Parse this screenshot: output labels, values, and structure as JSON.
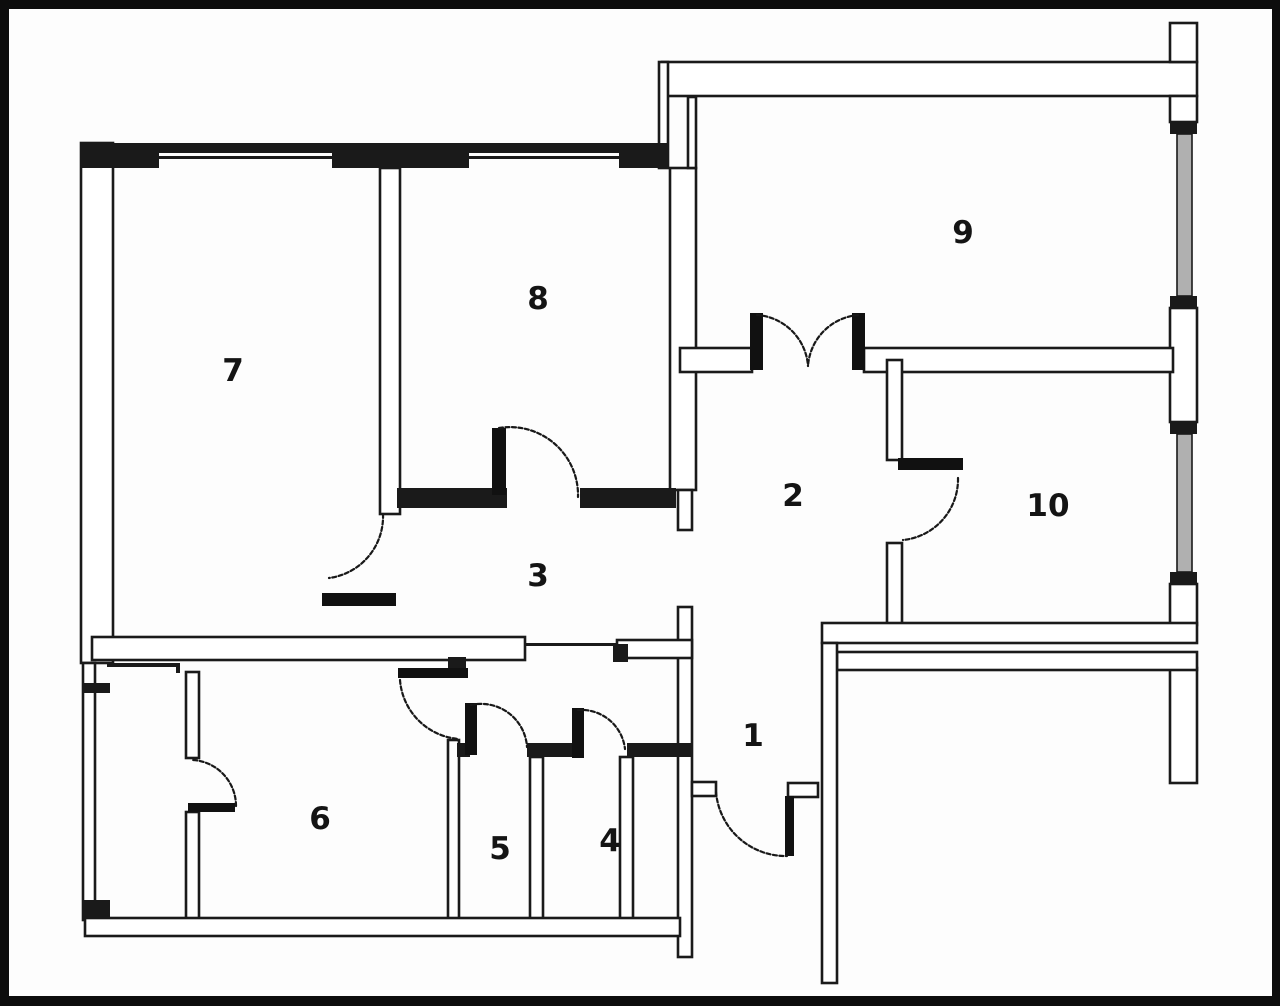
{
  "diagram": {
    "type": "floor-plan",
    "background_color": "#fdfdfd",
    "wall_color": "#1a1a1a",
    "glazing_color": "#b0b0b0",
    "rooms": [
      {
        "label": "1"
      },
      {
        "label": "2"
      },
      {
        "label": "3"
      },
      {
        "label": "4"
      },
      {
        "label": "5"
      },
      {
        "label": "6"
      },
      {
        "label": "7"
      },
      {
        "label": "8"
      },
      {
        "label": "9"
      },
      {
        "label": "10"
      }
    ]
  }
}
